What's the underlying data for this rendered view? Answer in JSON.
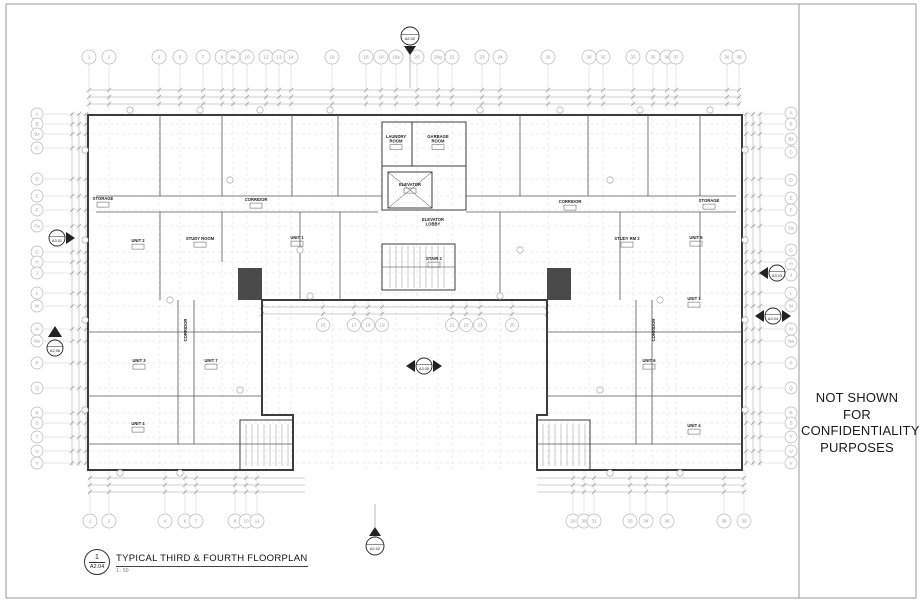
{
  "sheet": {
    "confidentiality_note": "NOT SHOWN FOR\nCONFIDENTIALITY\nPURPOSES",
    "title_block": {
      "detail_number": "1",
      "sheet_number": "A2.04",
      "title": "TYPICAL THIRD & FOURTH FLOORPLAN",
      "scale": "1 : 50"
    }
  },
  "grid": {
    "top": [
      [
        "1",
        89
      ],
      [
        "2",
        109
      ],
      [
        "3",
        159
      ],
      [
        "5",
        180
      ],
      [
        "7",
        203
      ],
      [
        "8",
        222
      ],
      [
        "8a",
        233
      ],
      [
        "10",
        247
      ],
      [
        "12",
        266
      ],
      [
        "13",
        279
      ],
      [
        "14",
        291
      ],
      [
        "16",
        332
      ],
      [
        "18",
        366
      ],
      [
        "19",
        381
      ],
      [
        "19a",
        396
      ],
      [
        "20",
        417
      ],
      [
        "20g",
        438
      ],
      [
        "21",
        452
      ],
      [
        "23",
        482
      ],
      [
        "24",
        500
      ],
      [
        "26",
        548
      ],
      [
        "30",
        589
      ],
      [
        "32",
        603
      ],
      [
        "33",
        633
      ],
      [
        "35",
        653
      ],
      [
        "36",
        667
      ],
      [
        "37",
        676
      ],
      [
        "38",
        727
      ],
      [
        "39",
        739
      ]
    ],
    "bottom": [
      [
        "1",
        90
      ],
      [
        "2",
        109
      ],
      [
        "4",
        165
      ],
      [
        "6",
        185
      ],
      [
        "7",
        196
      ],
      [
        "9",
        235
      ],
      [
        "10",
        246
      ],
      [
        "11",
        257
      ],
      [
        "29",
        573
      ],
      [
        "30",
        584
      ],
      [
        "31",
        594
      ],
      [
        "33",
        630
      ],
      [
        "34",
        646
      ],
      [
        "36",
        667
      ],
      [
        "38",
        724
      ],
      [
        "39",
        744
      ]
    ],
    "courtyard": [
      [
        "15",
        323
      ],
      [
        "17",
        354
      ],
      [
        "18",
        368
      ],
      [
        "19",
        382
      ],
      [
        "21",
        452
      ],
      [
        "22",
        466
      ],
      [
        "23",
        480
      ],
      [
        "25",
        512
      ]
    ],
    "left": [
      [
        "A",
        114
      ],
      [
        "B",
        124
      ],
      [
        "Bx",
        134
      ],
      [
        "C",
        148
      ],
      [
        "D",
        179
      ],
      [
        "E",
        196
      ],
      [
        "F",
        210
      ],
      [
        "Fa",
        226
      ],
      [
        "G",
        252
      ],
      [
        "H",
        262
      ],
      [
        "J",
        273
      ],
      [
        "L",
        293
      ],
      [
        "M",
        306
      ],
      [
        "N",
        329
      ],
      [
        "Na",
        341
      ],
      [
        "P",
        363
      ],
      [
        "Q",
        388
      ],
      [
        "R",
        413
      ],
      [
        "S",
        423
      ],
      [
        "T",
        437
      ],
      [
        "U",
        451
      ],
      [
        "V",
        463
      ]
    ],
    "right": [
      [
        "A",
        113
      ],
      [
        "B",
        124
      ],
      [
        "Bx",
        139
      ],
      [
        "C",
        152
      ],
      [
        "D",
        180
      ],
      [
        "E",
        198
      ],
      [
        "F",
        210
      ],
      [
        "Fa",
        228
      ],
      [
        "G",
        250
      ],
      [
        "H",
        264
      ],
      [
        "J",
        275
      ],
      [
        "L",
        293
      ],
      [
        "M",
        306
      ],
      [
        "N",
        329
      ],
      [
        "Na",
        341
      ],
      [
        "P",
        363
      ],
      [
        "Q",
        388
      ],
      [
        "R",
        413
      ],
      [
        "S",
        423
      ],
      [
        "T",
        437
      ],
      [
        "U",
        451
      ],
      [
        "V",
        463
      ]
    ]
  },
  "view_markers": [
    {
      "label": "A2.02",
      "x": 410,
      "y": 36,
      "arrow": "down"
    },
    {
      "label": "A2.02",
      "x": 375,
      "y": 546,
      "arrow": "up"
    },
    {
      "label": "A3.01",
      "x": 57,
      "y": 238,
      "arrow": "right"
    },
    {
      "label": "A3.03",
      "x": 777,
      "y": 273,
      "arrow": "left"
    },
    {
      "label": "A3.05",
      "x": 424,
      "y": 366,
      "arrow": "left-right"
    },
    {
      "label": "A3.04",
      "x": 773,
      "y": 316,
      "arrow": "left-right"
    },
    {
      "label": "A2.06",
      "x": 55,
      "y": 348,
      "arrow": "tri-up"
    }
  ],
  "rooms": [
    {
      "label": "STORAGE",
      "x": 103,
      "y": 200,
      "tag": true
    },
    {
      "label": "CORRIDOR",
      "x": 256,
      "y": 201,
      "tag": true
    },
    {
      "label": "CORRIDOR",
      "x": 570,
      "y": 203,
      "tag": true
    },
    {
      "label": "STORAGE",
      "x": 709,
      "y": 202,
      "tag": true
    },
    {
      "label": "LAUNDRY\nROOM",
      "x": 396,
      "y": 138,
      "tag": true
    },
    {
      "label": "GARBAGE\nROOM",
      "x": 438,
      "y": 138,
      "tag": true
    },
    {
      "label": "ELEVATOR",
      "x": 410,
      "y": 186,
      "tag": true
    },
    {
      "label": "ELEVATOR\nLOBBY",
      "x": 433,
      "y": 221,
      "tag": false
    },
    {
      "label": "STAIR 2",
      "x": 434,
      "y": 260,
      "tag": true
    },
    {
      "label": "STUDY ROOM",
      "x": 200,
      "y": 240,
      "tag": true
    },
    {
      "label": "UNIT 2",
      "x": 138,
      "y": 242,
      "tag": true
    },
    {
      "label": "UNIT 1",
      "x": 297,
      "y": 239,
      "tag": true
    },
    {
      "label": "STUDY RM 2",
      "x": 627,
      "y": 240,
      "tag": true
    },
    {
      "label": "UNIT 5",
      "x": 696,
      "y": 239,
      "tag": true
    },
    {
      "label": "UNIT 3",
      "x": 139,
      "y": 362,
      "tag": true
    },
    {
      "label": "UNIT 7",
      "x": 211,
      "y": 362,
      "tag": true
    },
    {
      "label": "UNIT 4",
      "x": 138,
      "y": 425,
      "tag": true
    },
    {
      "label": "UNIT 1",
      "x": 694,
      "y": 300,
      "tag": true
    },
    {
      "label": "UNIT 6",
      "x": 649,
      "y": 362,
      "tag": true
    },
    {
      "label": "UNIT 4",
      "x": 694,
      "y": 427,
      "tag": true
    },
    {
      "label": "CORRIDOR",
      "x": 187,
      "y": 330,
      "rot": -90
    },
    {
      "label": "CORRIDOR",
      "x": 655,
      "y": 330,
      "rot": -90
    }
  ]
}
